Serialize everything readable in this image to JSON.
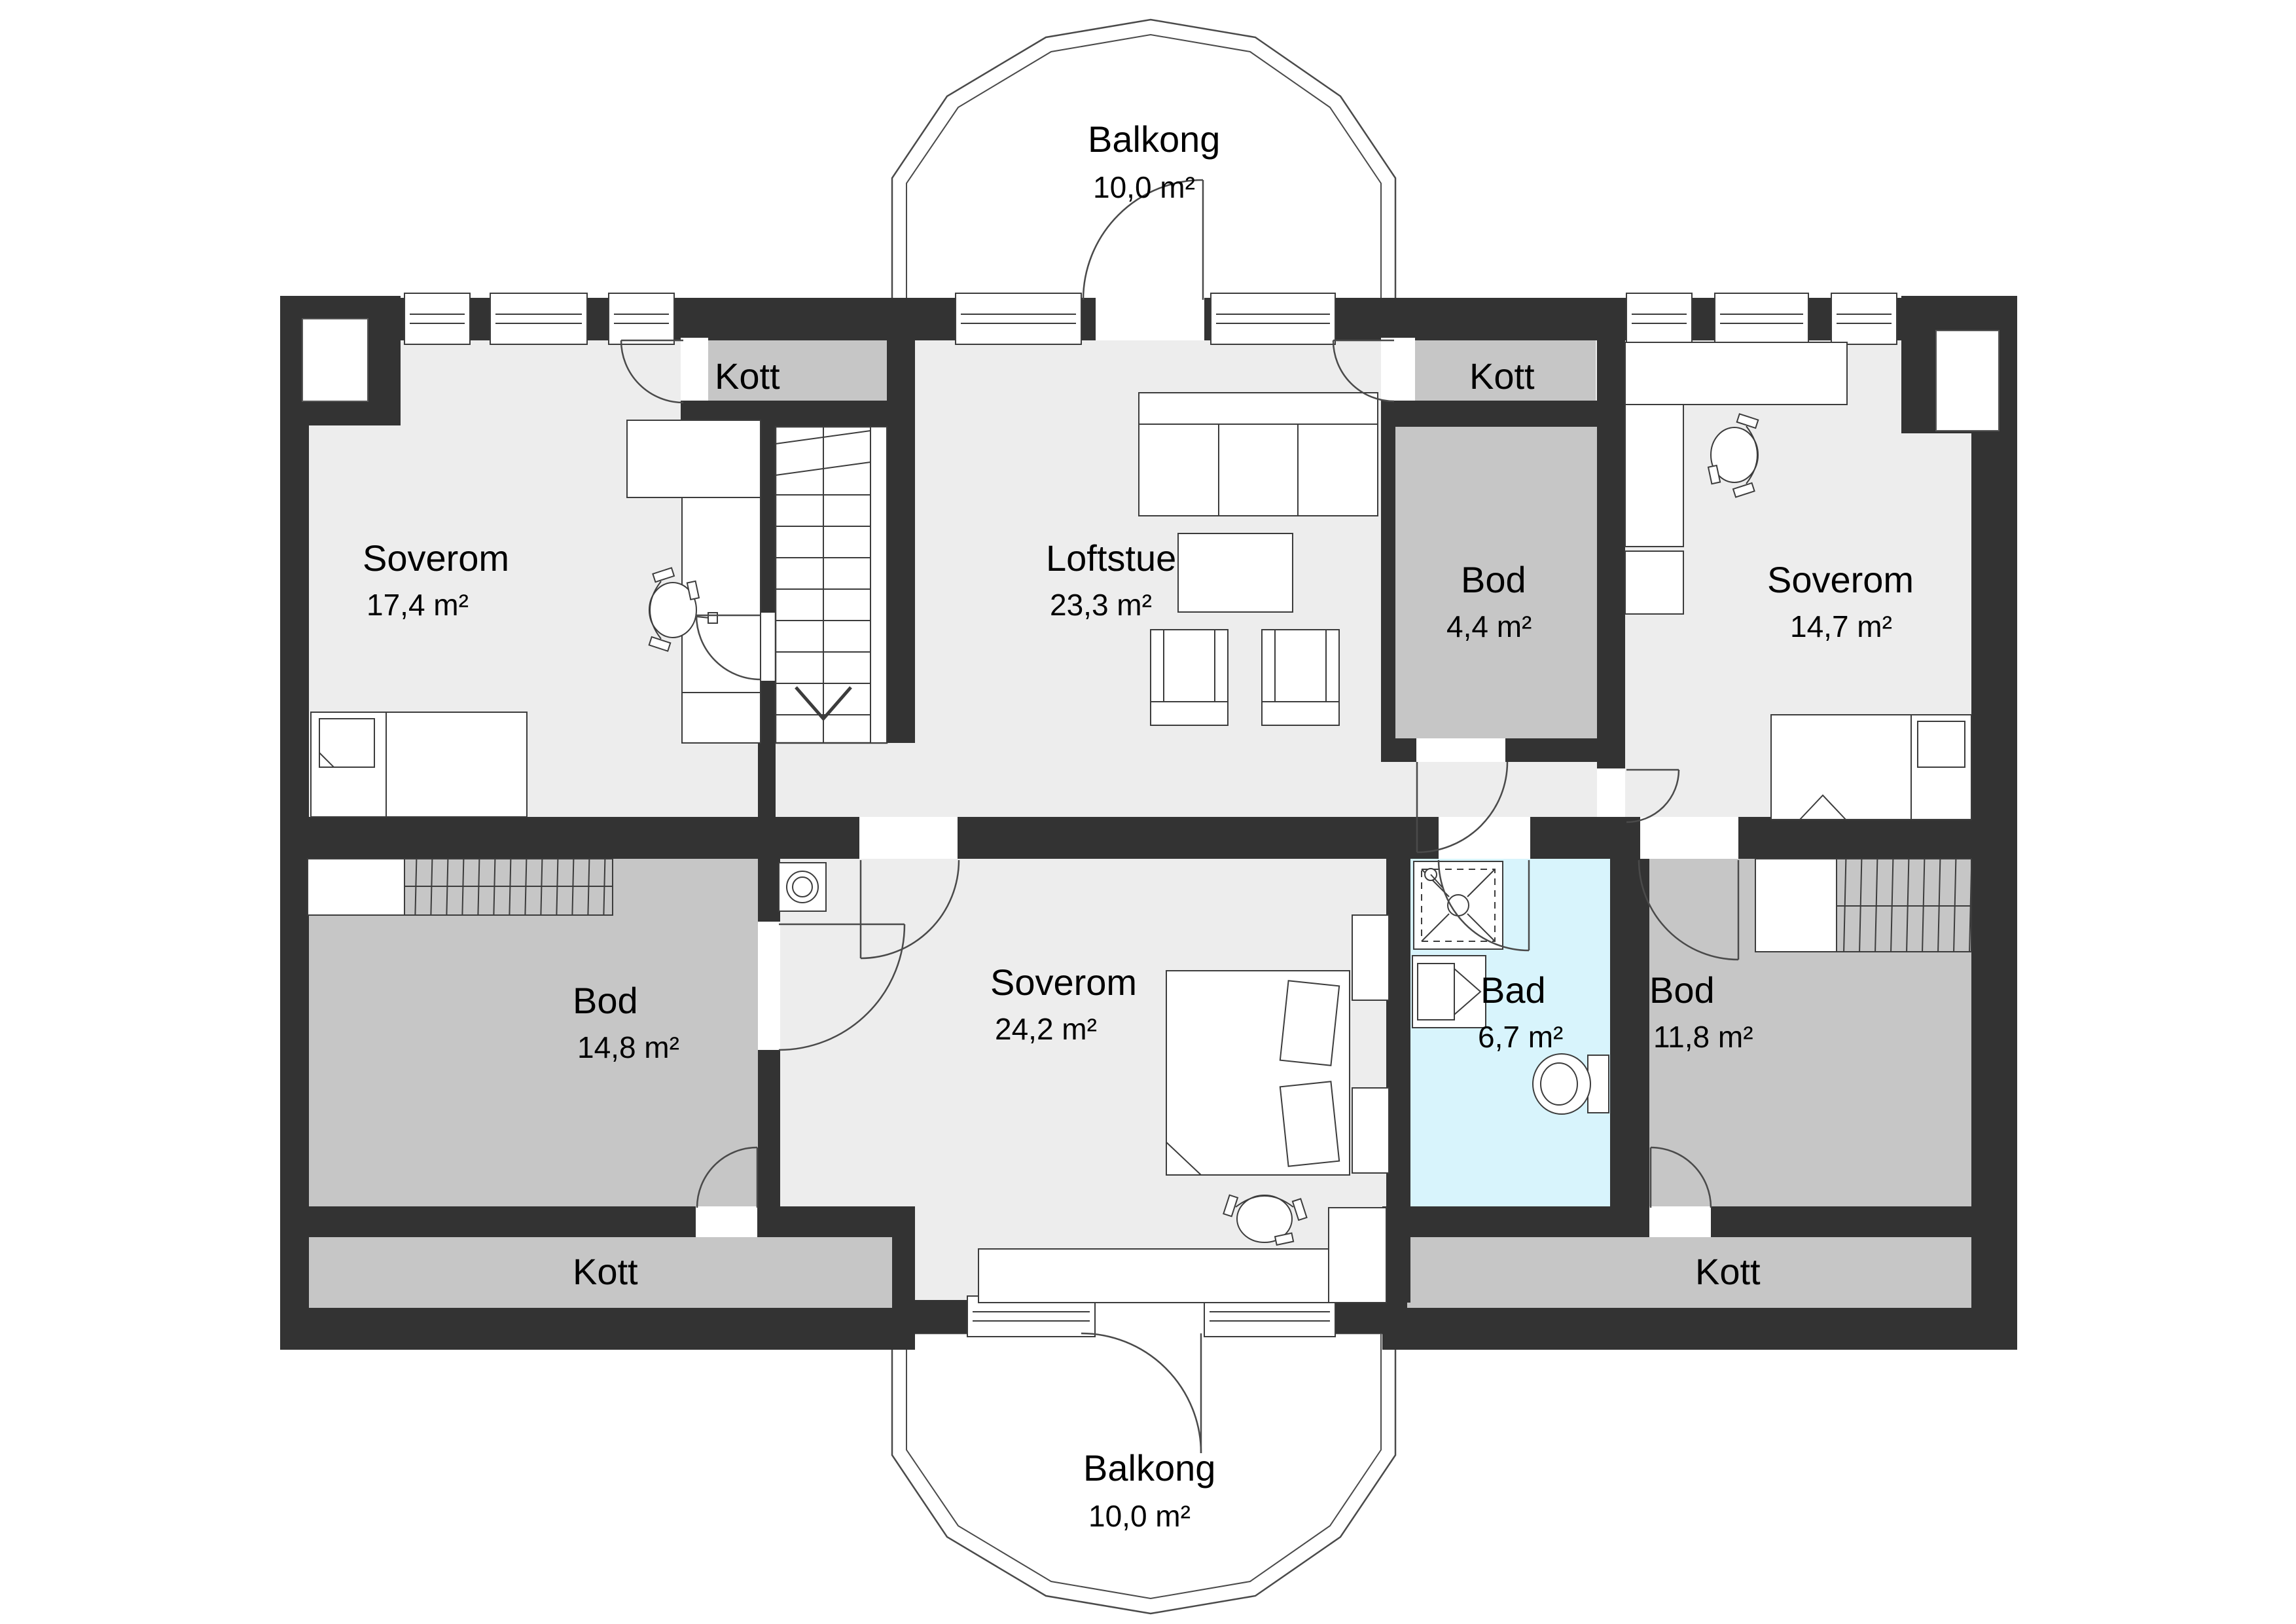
{
  "plan": {
    "type": "floor-plan",
    "language": "Norwegian",
    "colors": {
      "wall": "#333333",
      "floor": "#ededed",
      "storage_room": "#c6c6c6",
      "bathroom": "#d8f4fc",
      "background": "#ffffff"
    },
    "rooms": [
      {
        "key": "balkong_top",
        "name": "Balkong",
        "area": "10,0 m²"
      },
      {
        "key": "soverom_nw",
        "name": "Soverom",
        "area": "17,4 m²"
      },
      {
        "key": "kott_nw",
        "name": "Kott"
      },
      {
        "key": "loftstue",
        "name": "Loftstue",
        "area": "23,3 m²"
      },
      {
        "key": "bod_small",
        "name": "Bod",
        "area": "4,4 m²"
      },
      {
        "key": "kott_ne",
        "name": "Kott"
      },
      {
        "key": "soverom_ne",
        "name": "Soverom",
        "area": "14,7 m²"
      },
      {
        "key": "bod_sw",
        "name": "Bod",
        "area": "14,8 m²"
      },
      {
        "key": "soverom_s",
        "name": "Soverom",
        "area": "24,2 m²"
      },
      {
        "key": "bad",
        "name": "Bad",
        "area": "6,7 m²"
      },
      {
        "key": "bod_se",
        "name": "Bod",
        "area": "11,8 m²"
      },
      {
        "key": "kott_sw",
        "name": "Kott"
      },
      {
        "key": "kott_se",
        "name": "Kott"
      },
      {
        "key": "balkong_bottom",
        "name": "Balkong",
        "area": "10,0 m²"
      }
    ]
  }
}
